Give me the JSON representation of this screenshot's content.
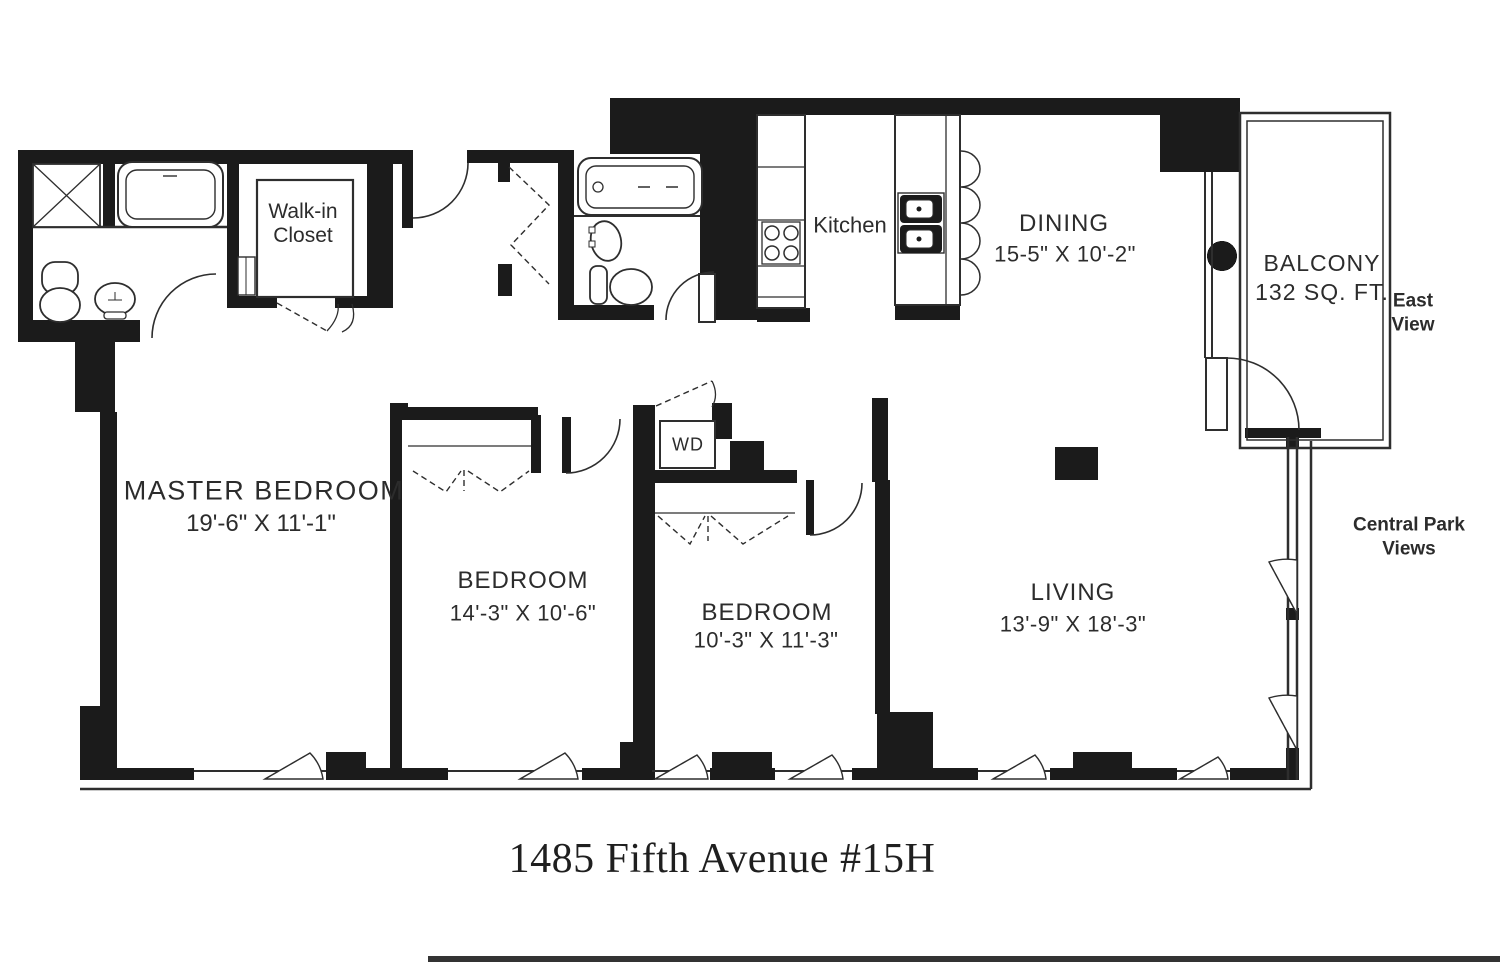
{
  "colors": {
    "walls": "#1b1b1b",
    "lines": "#2e2e2e",
    "text": "#2c2c2c",
    "background": "#ffffff"
  },
  "title": "1485 Fifth Avenue #15H",
  "rooms": {
    "master_bedroom": {
      "name": "MASTER BEDROOM",
      "dims": "19'-6\" X 11'-1\""
    },
    "bedroom_2": {
      "name": "BEDROOM",
      "dims": "14'-3\" X 10'-6\""
    },
    "bedroom_3": {
      "name": "BEDROOM",
      "dims": "10'-3\" X 11'-3\""
    },
    "living": {
      "name": "LIVING",
      "dims": "13'-9\" X 18'-3\""
    },
    "dining": {
      "name": "DINING",
      "dims": "15-5\" X 10'-2\""
    },
    "kitchen": {
      "name": "Kitchen"
    },
    "balcony": {
      "name": "BALCONY",
      "area": "132 SQ. FT."
    },
    "walk_in_closet": {
      "line1": "Walk-in",
      "line2": "Closet"
    },
    "wd_closet": {
      "name": "WD"
    }
  },
  "views": {
    "east": {
      "line1": "East",
      "line2": "View"
    },
    "central_park": {
      "line1": "Central Park",
      "line2": "Views"
    }
  }
}
